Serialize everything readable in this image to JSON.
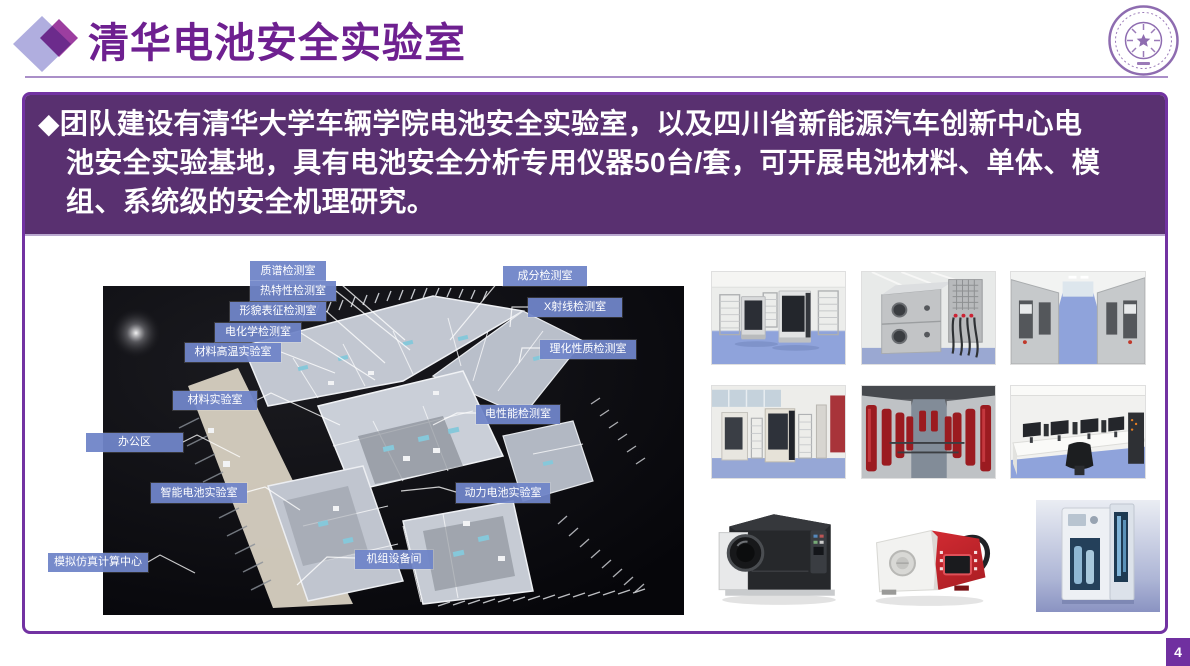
{
  "header": {
    "title": "清华电池安全实验室",
    "logo": "tsinghua-university-seal"
  },
  "summary": {
    "lines": [
      "◆团队建设有清华大学车辆学院电池安全实验室，以及四川省新能源汽车创新中心电",
      "池安全实验基地，具有电池安全分析专用仪器50台/套，可开展电池材料、单体、模",
      "组、系统级的安全机理研究。"
    ]
  },
  "floorplan": {
    "description": "3d-lab-floorplan-on-black",
    "labels": [
      {
        "text": "质谱检测室",
        "x": 225,
        "y": 166,
        "w": 76,
        "h": 20
      },
      {
        "text": "热特性检测室",
        "x": 225,
        "y": 186,
        "w": 86,
        "h": 20
      },
      {
        "text": "形貌表征检测室",
        "x": 205,
        "y": 207,
        "w": 96,
        "h": 19
      },
      {
        "text": "电化学检测室",
        "x": 190,
        "y": 228,
        "w": 86,
        "h": 19
      },
      {
        "text": "材料高温实验室",
        "x": 160,
        "y": 248,
        "w": 96,
        "h": 19
      },
      {
        "text": "材料实验室",
        "x": 148,
        "y": 296,
        "w": 84,
        "h": 19
      },
      {
        "text": "办公区",
        "x": 61,
        "y": 338,
        "w": 97,
        "h": 19
      },
      {
        "text": "智能电池实验室",
        "x": 126,
        "y": 388,
        "w": 96,
        "h": 20
      },
      {
        "text": "模拟仿真计算中心",
        "x": 23,
        "y": 458,
        "w": 100,
        "h": 19
      },
      {
        "text": "成分检测室",
        "x": 478,
        "y": 171,
        "w": 84,
        "h": 20
      },
      {
        "text": "X射线检测室",
        "x": 503,
        "y": 203,
        "w": 94,
        "h": 19
      },
      {
        "text": "理化性质检测室",
        "x": 515,
        "y": 245,
        "w": 96,
        "h": 19
      },
      {
        "text": "电性能检测室",
        "x": 451,
        "y": 310,
        "w": 84,
        "h": 19
      },
      {
        "text": "动力电池实验室",
        "x": 431,
        "y": 388,
        "w": 94,
        "h": 20
      },
      {
        "text": "机组设备间",
        "x": 330,
        "y": 455,
        "w": 78,
        "h": 19
      }
    ]
  },
  "photos": [
    {
      "name": "battery-cycling-chamber-room"
    },
    {
      "name": "environmental-test-chambers"
    },
    {
      "name": "test-chamber-corridor"
    },
    {
      "name": "battery-test-cabinets-room"
    },
    {
      "name": "fire-suppression-cylinder-corridor"
    },
    {
      "name": "simulation-computer-room"
    },
    {
      "name": "mass-spectrometer-instrument"
    },
    {
      "name": "portable-analyzer-red"
    },
    {
      "name": "particle-size-analyzer"
    }
  ],
  "page": {
    "number": "4"
  },
  "colors": {
    "title_purple": "#6E2090",
    "frame_border": "#7232A2",
    "summary_fill": "#593070",
    "label_chip": "#7085C8",
    "page_number_bg": "#7030A0",
    "diamond_light": "#B0AEDF",
    "diamond_dark": "#9C3EA0",
    "photo_floor_blue": "#8FA3DB"
  }
}
